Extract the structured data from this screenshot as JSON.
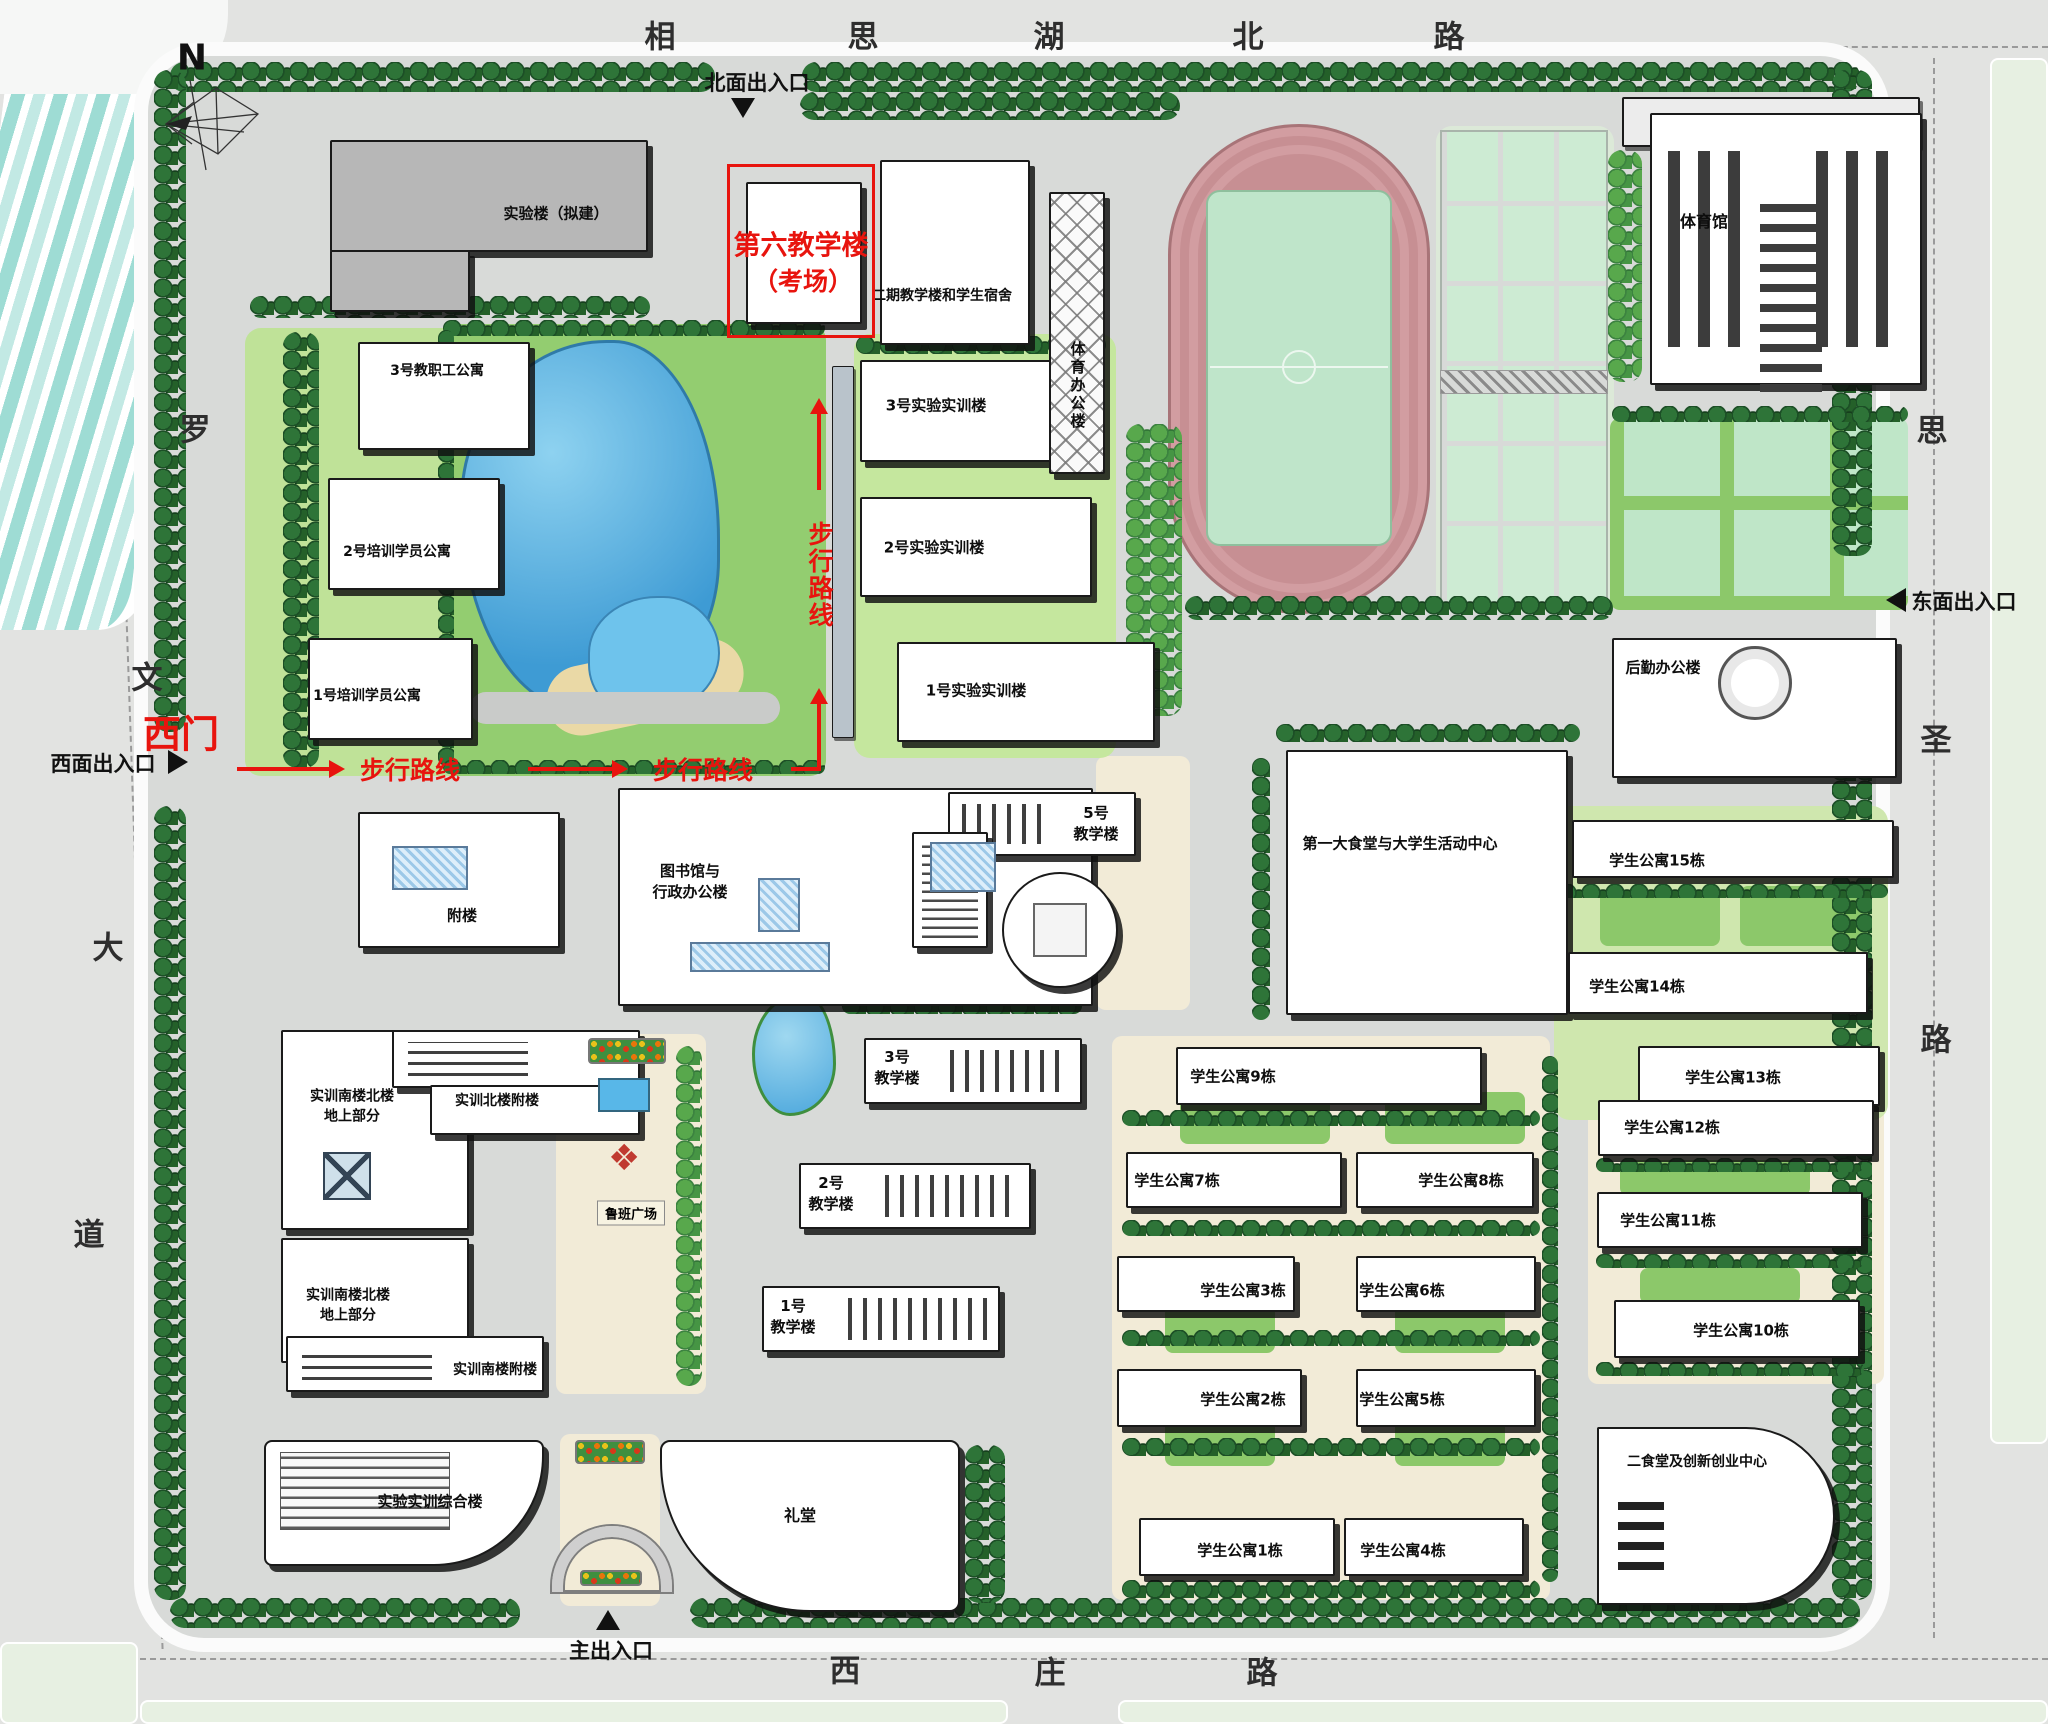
{
  "roads": {
    "top": {
      "name": "相思湖北路",
      "chars": [
        {
          "ch": "相",
          "x": 660,
          "y": 34
        },
        {
          "ch": "思",
          "x": 863,
          "y": 34
        },
        {
          "ch": "湖",
          "x": 1049,
          "y": 34
        },
        {
          "ch": "北",
          "x": 1248,
          "y": 34
        },
        {
          "ch": "路",
          "x": 1449,
          "y": 34
        }
      ]
    },
    "left": {
      "name": "罗文大道",
      "chars": [
        {
          "ch": "罗",
          "x": 195,
          "y": 427
        },
        {
          "ch": "文",
          "x": 147,
          "y": 675
        },
        {
          "ch": "大",
          "x": 108,
          "y": 945
        },
        {
          "ch": "道",
          "x": 89,
          "y": 1232
        }
      ]
    },
    "right": {
      "name": "思圣路",
      "chars": [
        {
          "ch": "思",
          "x": 1932,
          "y": 428
        },
        {
          "ch": "圣",
          "x": 1936,
          "y": 737
        },
        {
          "ch": "路",
          "x": 1936,
          "y": 1037
        }
      ]
    },
    "bottom": {
      "name": "西庄路",
      "chars": [
        {
          "ch": "西",
          "x": 845,
          "y": 1668
        },
        {
          "ch": "庄",
          "x": 1050,
          "y": 1670
        },
        {
          "ch": "路",
          "x": 1262,
          "y": 1670
        }
      ]
    }
  },
  "entrances": [
    {
      "id": "north",
      "label": "北面出入口",
      "x": 757,
      "y": 82,
      "arrow": "down",
      "ax": 731,
      "ay": 98
    },
    {
      "id": "west",
      "label": "西面出入口",
      "x": 103,
      "y": 763,
      "arrow": "right",
      "ax": 168,
      "ay": 750
    },
    {
      "id": "east",
      "label": "东面出入口",
      "x": 1964,
      "y": 601,
      "arrow": "left",
      "ax": 1886,
      "ay": 588
    },
    {
      "id": "main",
      "label": "主出入口",
      "x": 611,
      "y": 1650,
      "arrow": "up",
      "ax": 596,
      "ay": 1610
    }
  ],
  "route": {
    "gate_label": "西门",
    "walk_labels": [
      {
        "text": "步行路线",
        "x": 410,
        "y": 769,
        "vertical": false
      },
      {
        "text": "步行路线",
        "x": 703,
        "y": 769,
        "vertical": false
      },
      {
        "text": "步行路线",
        "x": 819,
        "y": 575,
        "vertical": true
      }
    ],
    "exam_lines": [
      "第六教学楼",
      "（考场）"
    ]
  },
  "landmarks": {
    "north_arrow": "N",
    "luban_square": "鲁班广场"
  },
  "buildings": [
    {
      "id": "lab-proposed",
      "label": "实验楼（拟建）",
      "x": 330,
      "y": 140,
      "w": 318,
      "h": 112,
      "cls": "gray",
      "lx": 556,
      "ly": 214
    },
    {
      "id": "lab-proposed-wing",
      "x": 330,
      "y": 250,
      "w": 140,
      "h": 62,
      "cls": "gray"
    },
    {
      "id": "bldg6-exam",
      "x": 746,
      "y": 182,
      "w": 116,
      "h": 142
    },
    {
      "id": "phase2-dorm",
      "label": "二期教学楼和学生宿舍",
      "x": 880,
      "y": 160,
      "w": 150,
      "h": 185,
      "lx": 942,
      "ly": 297,
      "fs": 14
    },
    {
      "id": "apt-staff-3",
      "label": "3号教职工公寓",
      "x": 358,
      "y": 342,
      "w": 172,
      "h": 108,
      "lx": 437,
      "ly": 372,
      "fs": 14
    },
    {
      "id": "apt-trainee-2",
      "label": "2号培训学员公寓",
      "x": 328,
      "y": 478,
      "w": 172,
      "h": 112,
      "lx": 397,
      "ly": 553,
      "fs": 14
    },
    {
      "id": "apt-trainee-1",
      "label": "1号培训学员公寓",
      "x": 308,
      "y": 638,
      "w": 165,
      "h": 102,
      "lx": 367,
      "ly": 697,
      "fs": 14
    },
    {
      "id": "corridor-strip",
      "x": 832,
      "y": 366,
      "w": 22,
      "h": 372,
      "cls": "strip"
    },
    {
      "id": "shixun-3",
      "label": "3号实验实训楼",
      "x": 860,
      "y": 360,
      "w": 232,
      "h": 102,
      "lx": 936,
      "ly": 406
    },
    {
      "id": "shixun-2",
      "label": "2号实验实训楼",
      "x": 860,
      "y": 497,
      "w": 232,
      "h": 100,
      "lx": 934,
      "ly": 548
    },
    {
      "id": "shixun-1",
      "label": "1号实验实训楼",
      "x": 897,
      "y": 642,
      "w": 258,
      "h": 100,
      "lx": 976,
      "ly": 691
    },
    {
      "id": "sports-office",
      "label": "体育办公楼",
      "x": 1049,
      "y": 192,
      "w": 56,
      "h": 282,
      "cls": "lattice",
      "vert": true,
      "lx": 1077,
      "ly": 386
    },
    {
      "id": "gym-annex",
      "x": 1622,
      "y": 97,
      "w": 298,
      "h": 50,
      "cls": "graylight"
    },
    {
      "id": "gym",
      "label": "体育馆",
      "x": 1650,
      "y": 113,
      "w": 272,
      "h": 272,
      "cls": "gym",
      "lx": 1704,
      "ly": 222,
      "fs": 16
    },
    {
      "id": "logistics-office",
      "label": "后勤办公楼",
      "x": 1612,
      "y": 638,
      "w": 285,
      "h": 140,
      "lx": 1663,
      "ly": 668
    },
    {
      "id": "canteen-1",
      "label": "第一大食堂与大学生活动中心",
      "x": 1286,
      "y": 750,
      "w": 282,
      "h": 265,
      "lx": 1400,
      "ly": 844
    },
    {
      "id": "apt-15",
      "label": "学生公寓15栋",
      "x": 1572,
      "y": 820,
      "w": 322,
      "h": 58,
      "lx": 1657,
      "ly": 861
    },
    {
      "id": "apt-14",
      "label": "学生公寓14栋",
      "x": 1568,
      "y": 952,
      "w": 300,
      "h": 62,
      "lx": 1637,
      "ly": 987
    },
    {
      "id": "apt-13",
      "label": "学生公寓13栋",
      "x": 1638,
      "y": 1046,
      "w": 242,
      "h": 60,
      "lx": 1733,
      "ly": 1078
    },
    {
      "id": "apt-12",
      "label": "学生公寓12栋",
      "x": 1598,
      "y": 1100,
      "w": 276,
      "h": 56,
      "lx": 1672,
      "ly": 1128
    },
    {
      "id": "apt-11",
      "label": "学生公寓11栋",
      "x": 1597,
      "y": 1192,
      "w": 266,
      "h": 56,
      "lx": 1668,
      "ly": 1221
    },
    {
      "id": "apt-10",
      "label": "学生公寓10栋",
      "x": 1614,
      "y": 1300,
      "w": 246,
      "h": 58,
      "lx": 1741,
      "ly": 1331
    },
    {
      "id": "apt-9",
      "label": "学生公寓9栋",
      "x": 1176,
      "y": 1047,
      "w": 306,
      "h": 58,
      "lx": 1233,
      "ly": 1077
    },
    {
      "id": "apt-7",
      "label": "学生公寓7栋",
      "x": 1126,
      "y": 1152,
      "w": 216,
      "h": 56,
      "lx": 1177,
      "ly": 1181
    },
    {
      "id": "apt-8",
      "label": "学生公寓8栋",
      "x": 1356,
      "y": 1152,
      "w": 178,
      "h": 56,
      "lx": 1461,
      "ly": 1181
    },
    {
      "id": "apt-3",
      "label": "学生公寓3栋",
      "x": 1117,
      "y": 1256,
      "w": 178,
      "h": 56,
      "lx": 1243,
      "ly": 1291
    },
    {
      "id": "apt-6",
      "label": "学生公寓6栋",
      "x": 1356,
      "y": 1256,
      "w": 180,
      "h": 56,
      "lx": 1402,
      "ly": 1291
    },
    {
      "id": "apt-2",
      "label": "学生公寓2栋",
      "x": 1117,
      "y": 1369,
      "w": 185,
      "h": 58,
      "lx": 1243,
      "ly": 1400
    },
    {
      "id": "apt-5",
      "label": "学生公寓5栋",
      "x": 1356,
      "y": 1369,
      "w": 180,
      "h": 58,
      "lx": 1402,
      "ly": 1400
    },
    {
      "id": "apt-1",
      "label": "学生公寓1栋",
      "x": 1139,
      "y": 1518,
      "w": 196,
      "h": 58,
      "lx": 1240,
      "ly": 1551
    },
    {
      "id": "apt-4",
      "label": "学生公寓4栋",
      "x": 1344,
      "y": 1518,
      "w": 180,
      "h": 58,
      "lx": 1403,
      "ly": 1551
    },
    {
      "id": "canteen-2",
      "label": "二食堂及创新创业中心",
      "x": 1597,
      "y": 1427,
      "w": 238,
      "h": 178,
      "cls": "rright",
      "lx": 1697,
      "ly": 1463,
      "fs": 14
    },
    {
      "id": "library-admin",
      "label": "图书馆与\n行政办公楼",
      "x": 618,
      "y": 788,
      "w": 475,
      "h": 218,
      "lx": 690,
      "ly": 882
    },
    {
      "id": "annex",
      "label": "附楼",
      "x": 358,
      "y": 812,
      "w": 202,
      "h": 136,
      "lx": 462,
      "ly": 916
    },
    {
      "id": "teach-5",
      "label": "5号\n教学楼",
      "x": 948,
      "y": 792,
      "w": 188,
      "h": 64,
      "cls": "comb-l",
      "lx": 1096,
      "ly": 824
    },
    {
      "id": "teach-5-wing",
      "x": 912,
      "y": 832,
      "w": 76,
      "h": 116,
      "cls": "ladder"
    },
    {
      "id": "round-hall",
      "x": 1002,
      "y": 872,
      "w": 116,
      "h": 116,
      "cls": "circle"
    },
    {
      "id": "teach-3",
      "label": "3号\n教学楼",
      "x": 864,
      "y": 1038,
      "w": 218,
      "h": 66,
      "cls": "comb-r",
      "lx": 897,
      "ly": 1068
    },
    {
      "id": "teach-2",
      "label": "2号\n教学楼",
      "x": 799,
      "y": 1163,
      "w": 232,
      "h": 66,
      "cls": "comb-r",
      "lx": 831,
      "ly": 1194
    },
    {
      "id": "teach-1",
      "label": "1号\n教学楼",
      "x": 762,
      "y": 1286,
      "w": 238,
      "h": 66,
      "cls": "comb-r",
      "lx": 793,
      "ly": 1317
    },
    {
      "id": "sx-north-tower",
      "label": "实训南楼北楼\n地上部分",
      "x": 281,
      "y": 1030,
      "w": 188,
      "h": 200,
      "lx": 352,
      "ly": 1107,
      "fs": 14
    },
    {
      "id": "sx-north-annex",
      "label": "实训北楼附楼",
      "x": 392,
      "y": 1030,
      "w": 248,
      "h": 58,
      "cls": "comb-h",
      "lx": 497,
      "ly": 1102,
      "fs": 14
    },
    {
      "id": "sx-annex-south-block",
      "x": 430,
      "y": 1085,
      "w": 210,
      "h": 50
    },
    {
      "id": "sx-south-tower",
      "label": "实训南楼北楼\n地上部分",
      "x": 281,
      "y": 1238,
      "w": 188,
      "h": 125,
      "lx": 348,
      "ly": 1306,
      "fs": 14
    },
    {
      "id": "sx-south-annex",
      "label": "实训南楼附楼",
      "x": 286,
      "y": 1336,
      "w": 258,
      "h": 56,
      "cls": "comb-h",
      "lx": 495,
      "ly": 1371,
      "fs": 14
    },
    {
      "id": "sx-complex",
      "label": "实验实训综合楼",
      "x": 264,
      "y": 1440,
      "w": 280,
      "h": 126,
      "cls": "rr",
      "lx": 430,
      "ly": 1502
    },
    {
      "id": "auditorium",
      "label": "礼堂",
      "x": 660,
      "y": 1440,
      "w": 300,
      "h": 172,
      "cls": "rleft",
      "lx": 800,
      "ly": 1516,
      "fs": 16
    }
  ],
  "colors": {
    "route_red": "#e8140e",
    "track_pink": "#c78f93",
    "infield_green": "#bfe5ca",
    "lake_blue": "#4fa8dc",
    "tree_dark_green": "#2a6c34",
    "lawn_green": "#a9d87f",
    "campus_gray": "#d8dad8",
    "building_white": "#ffffff",
    "pale_field_green": "#e7f0e2"
  }
}
